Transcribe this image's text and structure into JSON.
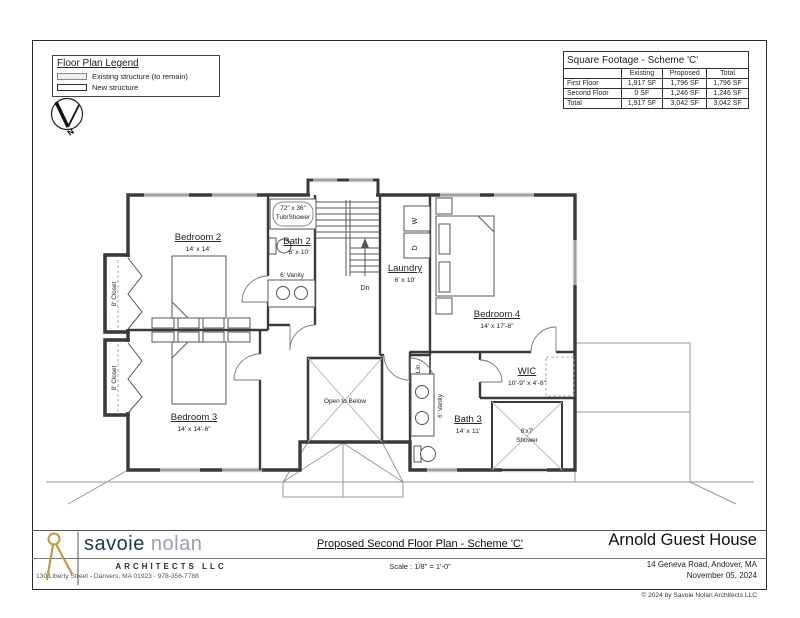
{
  "colors": {
    "ink": "#3a3a3a",
    "roofline": "#9a9a9a",
    "brand_navy": "#20365c",
    "brand_gray": "#94a0b4",
    "brand_gold": "#c49a3c"
  },
  "legend": {
    "title": "Floor Plan Legend",
    "item_existing": "Existing structure (to remain)",
    "item_new": "New structure"
  },
  "north": {
    "label": "N"
  },
  "sqft_table": {
    "title": "Square Footage - Scheme 'C'",
    "col_existing": "Existing",
    "col_proposed": "Proposed",
    "col_total": "Total",
    "rows": [
      {
        "label": "First Floor",
        "existing": "1,917 SF",
        "proposed": "1,796 SF",
        "total": "1,796 SF"
      },
      {
        "label": "Second Floor",
        "existing": "0 SF",
        "proposed": "1,246 SF",
        "total": "1,246 SF"
      },
      {
        "label": "Total",
        "existing": "1,917 SF",
        "proposed": "3,042 SF",
        "total": "3,042 SF"
      }
    ]
  },
  "plan": {
    "bedroom2": {
      "name": "Bedroom 2",
      "dims": "14' x 14'"
    },
    "bedroom3": {
      "name": "Bedroom 3",
      "dims": "14' x 14'-6\""
    },
    "bedroom4": {
      "name": "Bedroom 4",
      "dims": "14' x 17'-6\""
    },
    "bath2": {
      "name": "Bath 2",
      "dims": "6' x 10'"
    },
    "bath3": {
      "name": "Bath 3",
      "dims": "14' x 11'"
    },
    "laundry": {
      "name": "Laundry",
      "dims": "6' x 10'"
    },
    "wic": {
      "name": "WIC",
      "dims": "10'-9\" x 4'-8\""
    },
    "open_to_below": "Open to Below",
    "closet_upper": "8' Closet",
    "closet_lower": "8' Closet",
    "tub_line1": "72\" x 36\"",
    "tub_line2": "Tub/Shower",
    "vanity_bath2": "6' Vanity",
    "vanity_bath3": "6' Vanity",
    "linen": "Lin.",
    "shower_line1": "6'x7'",
    "shower_line2": "Shower",
    "stairs_down": "Dn",
    "washer": "W",
    "dryer": "D"
  },
  "titleblock": {
    "firm_name_1": "savoie",
    "firm_name_2": "nolan",
    "firm_sub": "ARCHITECTS LLC",
    "firm_address": "130 Liberty Street  -  Danvers, MA 01923  -  978-356-7788",
    "sheet_title": "Proposed Second Floor Plan - Scheme 'C'",
    "sheet_scale": "Scale : 1/8\" = 1'-0\"",
    "project_name": "Arnold Guest House",
    "project_address": "14 Geneva Road, Andover, MA",
    "project_date": "November 05, 2024",
    "copyright": "© 2024 by Savoie Nolan Architects LLC"
  }
}
